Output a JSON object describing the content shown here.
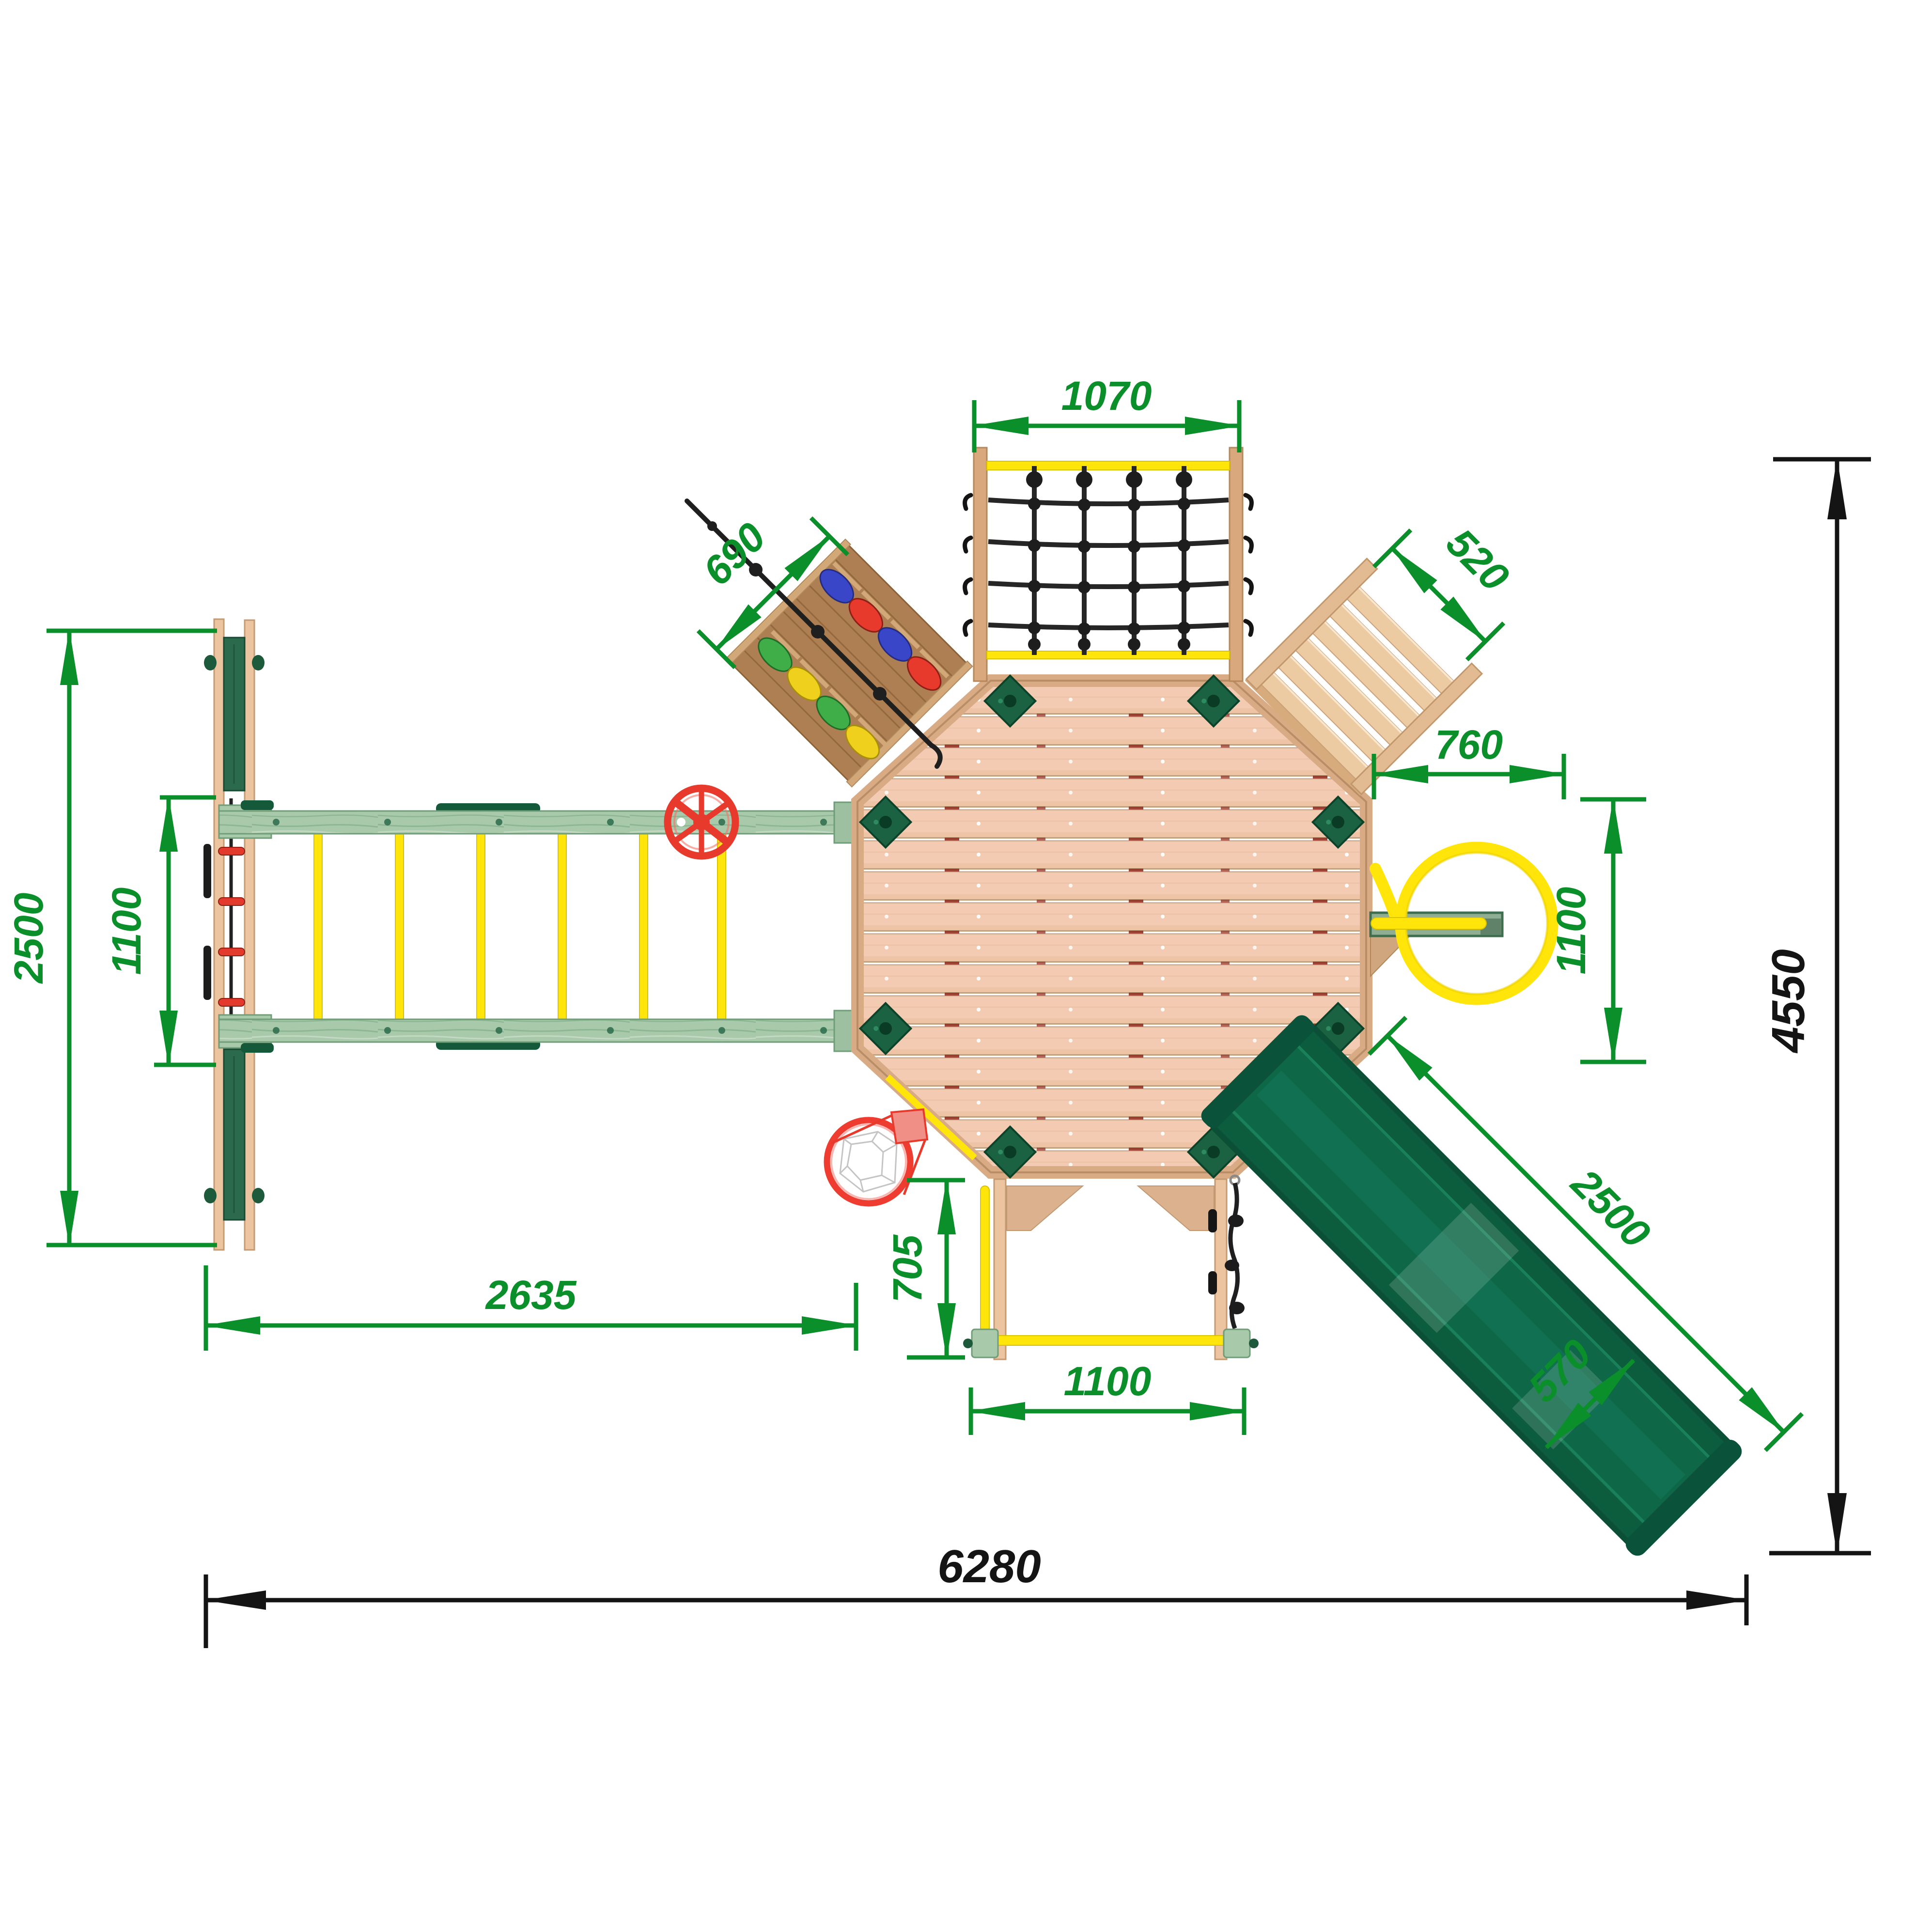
{
  "dimensions": {
    "net_width": {
      "value": "1070"
    },
    "wall_width": {
      "value": "690"
    },
    "stairs_width": {
      "value": "520"
    },
    "deck_to_ring": {
      "value": "760"
    },
    "ring_offset": {
      "value": "1100"
    },
    "left_wall_length": {
      "value": "2500"
    },
    "bridge_inner": {
      "value": "1100"
    },
    "bridge_length": {
      "value": "2635"
    },
    "bay_depth": {
      "value": "705"
    },
    "bay_width": {
      "value": "1100"
    },
    "slide_length": {
      "value": "2500"
    },
    "slide_width": {
      "value": "570"
    },
    "overall_width": {
      "value": "6280"
    },
    "overall_height": {
      "value": "4550"
    }
  },
  "colors": {
    "dimension_green": "#0a8f2a",
    "dimension_black": "#141414",
    "deck_wood": "#f2cbb2",
    "rim_wood": "#d8ab85",
    "beam_sage_green": "#a9c9ab",
    "bracket_dark_green": "#1a6242",
    "board_dark_green": "#2c6a4d",
    "slide_green": "#0e6847",
    "accent_yellow": "#ffe50a",
    "accent_red": "#e8392d",
    "rope_black": "#1f1f1f",
    "climb_wall_brown": "#ad7f52",
    "hold_blue": "#3a46c8",
    "hold_green": "#3fae49",
    "hold_yellow": "#efd11d",
    "stairs_wood": "#eccaa2"
  },
  "parts": [
    "octagonal-deck",
    "cargo-net-wall",
    "rock-climbing-wall",
    "access-stairs",
    "monkey-bar-bridge",
    "left-climbing-wall",
    "steering-wheel",
    "fire-pole-station",
    "slide",
    "lower-bay",
    "basketball-hoop"
  ]
}
